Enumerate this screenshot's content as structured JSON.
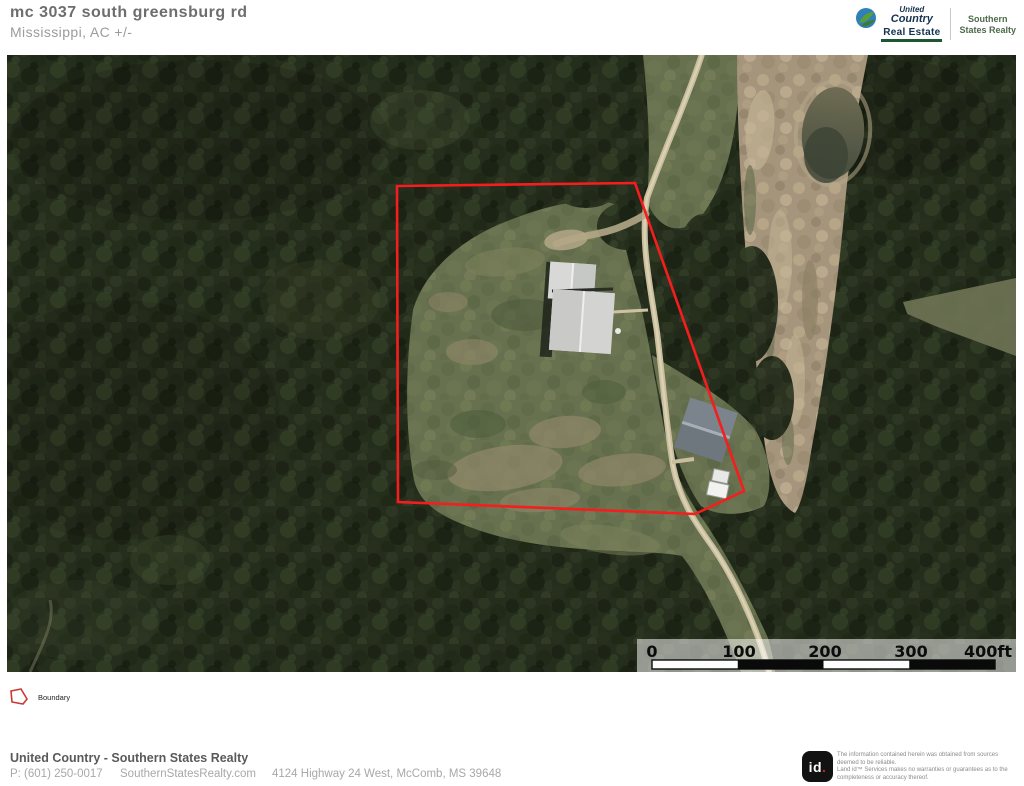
{
  "header": {
    "title": "mc 3037 south greensburg rd",
    "subtitle": "Mississippi,  AC +/-",
    "brand": {
      "united": "United",
      "country": "Country",
      "real_estate": "Real Estate",
      "office_line1": "Southern",
      "office_line2": "States Realty"
    }
  },
  "map": {
    "scale_bar": {
      "labels": [
        "0",
        "100",
        "200",
        "300",
        "400ft"
      ]
    },
    "legend": {
      "boundary_label": "Boundary"
    }
  },
  "footer": {
    "company": "United Country - Southern States Realty",
    "phone": "P: (601) 250-0017",
    "website": "SouthernStatesRealty.com",
    "address": "4124 Highway 24 West, McComb, MS 39648"
  },
  "attribution": {
    "logo_id": "id",
    "logo_dot": ".",
    "disclaimer_line1": "The information contained herein was obtained from sources deemed to be reliable.",
    "disclaimer_line2": "Land id™ Services makes no warranties or guarantees as to the completeness or accuracy thereof."
  },
  "colors": {
    "boundary_red": "#f51d1d",
    "brand_navy": "#16324f",
    "brand_green": "#1d5632",
    "office_green": "#4e6b4a",
    "forest_base": "#262e1d",
    "clearing_green": "#67714f",
    "bare_dirt_tan": "#a5957c",
    "road_tan": "#c9bd9e"
  }
}
